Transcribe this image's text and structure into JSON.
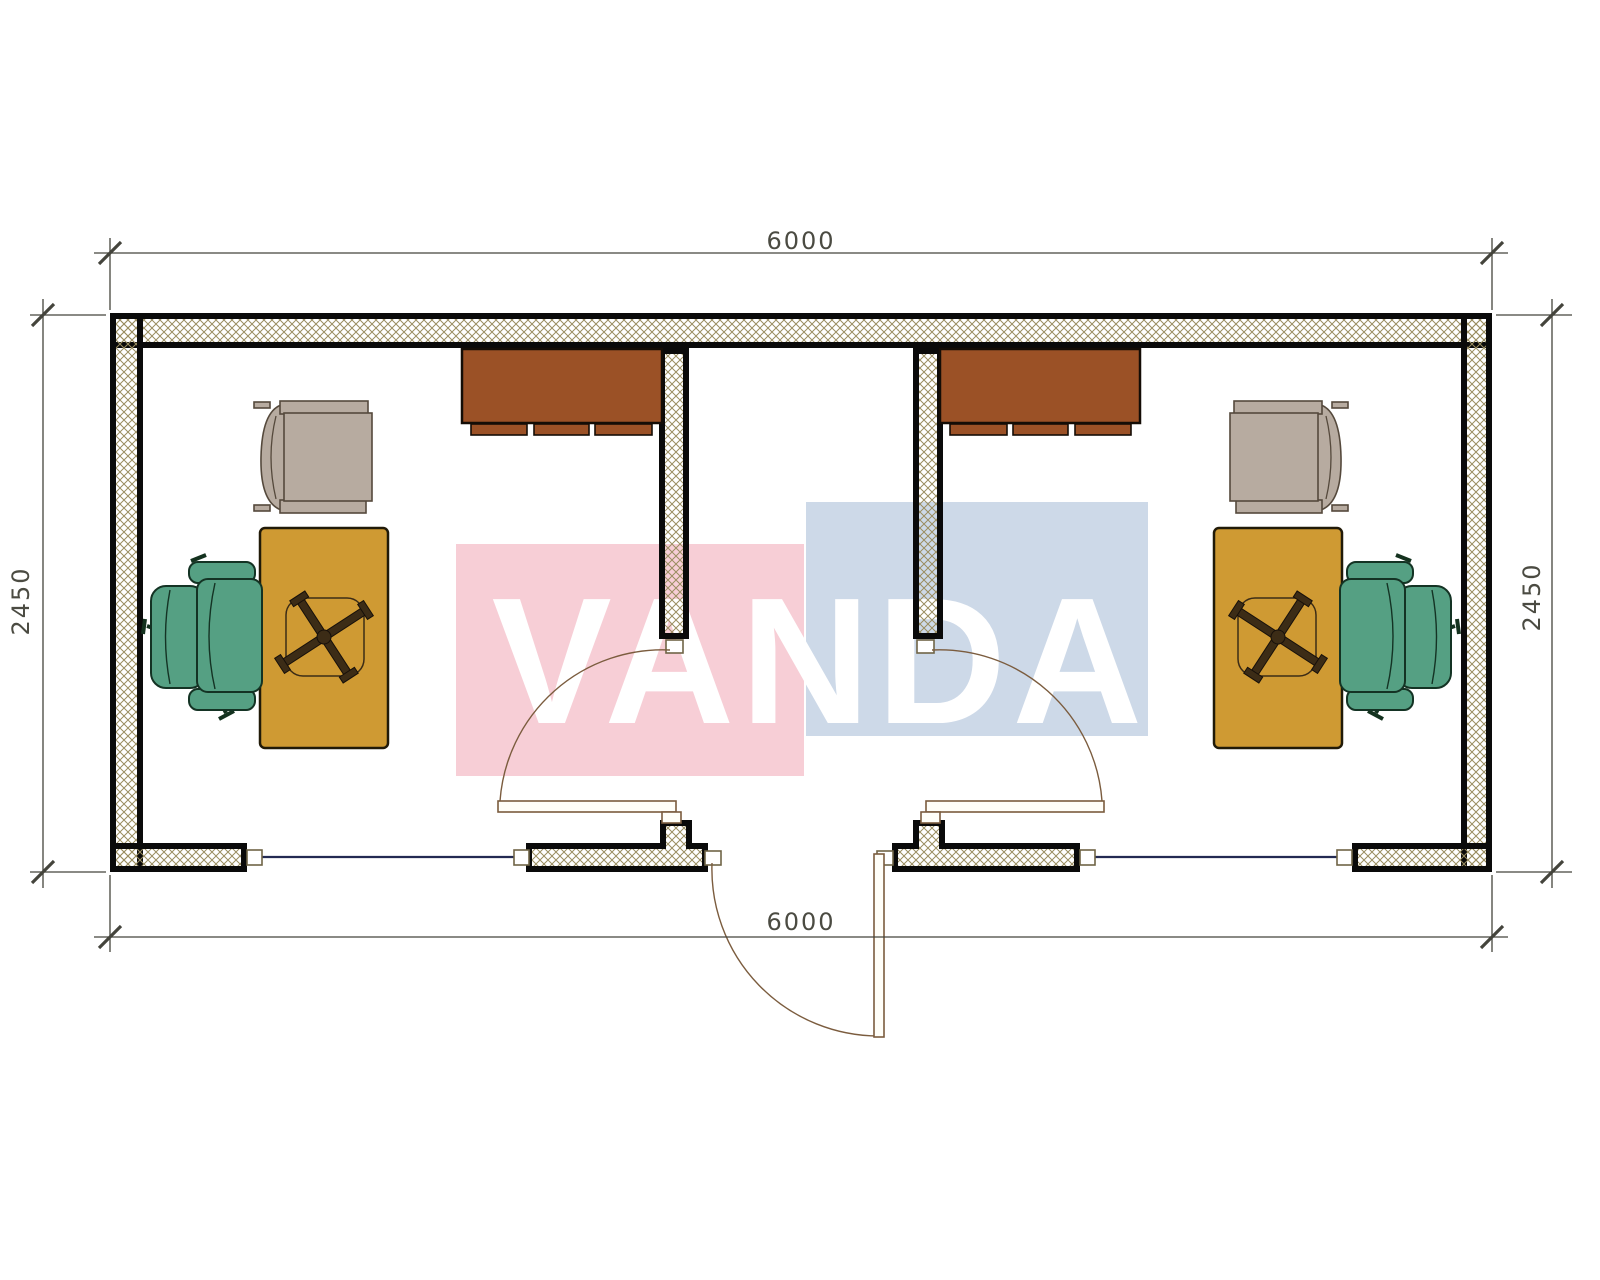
{
  "title": "office-container-floor-plan",
  "watermark": {
    "text": "VANDA",
    "pink_color": "#f7ced6",
    "blue_color": "#cdd9e8",
    "text_color": "#ffffff"
  },
  "dimensions": {
    "top": "6000",
    "bottom": "6000",
    "left": "2450",
    "right": "2450"
  },
  "palette": {
    "wall_hatch": "#9a8d60",
    "wall_stroke": "#0a0a0a",
    "desk": "#cf9a33",
    "cabinet": "#9b5126",
    "armchair": "#b7aba0",
    "office_chair": "#55a083",
    "window_line": "#232a52",
    "door_line": "#7b5c3e",
    "dimension_line": "#44443c"
  },
  "rooms": {
    "left_office": {
      "furniture": [
        "cabinet",
        "desk",
        "office-chair",
        "armchair"
      ],
      "door": "swing-into-room"
    },
    "corridor": {
      "doors": [
        "exterior-entry-door"
      ]
    },
    "right_office": {
      "furniture": [
        "cabinet",
        "desk",
        "office-chair",
        "armchair"
      ],
      "door": "swing-into-room"
    }
  }
}
